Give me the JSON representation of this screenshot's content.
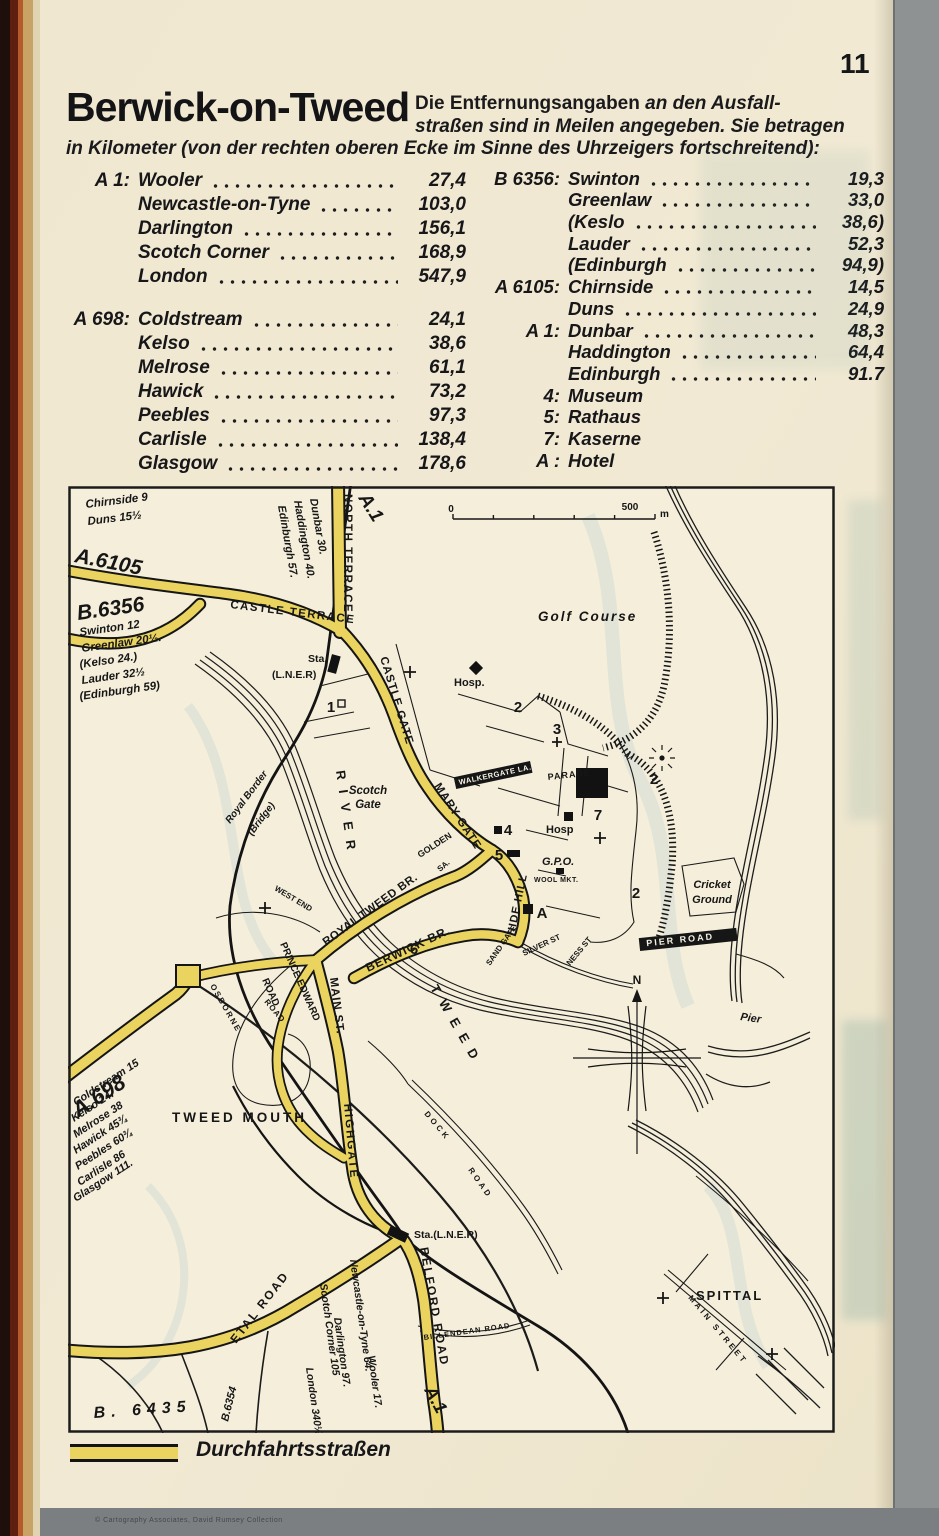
{
  "page": {
    "number": "11",
    "title": "Berwick-on-Tweed",
    "intro_bold": "Die Entfernungsangaben",
    "intro_1": "an den Ausfall-",
    "intro_2": "straßen sind in Meilen angegeben. Sie betragen",
    "intro_3": "in Kilometer (von der rechten oberen Ecke im Sinne des Uhrzeigers fortschreitend):"
  },
  "distances": {
    "left": [
      {
        "road": "A 1:",
        "entries": [
          [
            "Wooler",
            "27,4"
          ],
          [
            "Newcastle-on-Tyne",
            "103,0"
          ],
          [
            "Darlington",
            "156,1"
          ],
          [
            "Scotch Corner",
            "168,9"
          ],
          [
            "London",
            "547,9"
          ]
        ]
      },
      {
        "road": "A 698:",
        "entries": [
          [
            "Coldstream",
            "24,1"
          ],
          [
            "Kelso",
            "38,6"
          ],
          [
            "Melrose",
            "61,1"
          ],
          [
            "Hawick",
            "73,2"
          ],
          [
            "Peebles",
            "97,3"
          ],
          [
            "Carlisle",
            "138,4"
          ],
          [
            "Glasgow",
            "178,6"
          ]
        ]
      }
    ],
    "right": [
      {
        "road": "B 6356:",
        "entries": [
          [
            "Swinton",
            "19,3"
          ],
          [
            "Greenlaw",
            "33,0"
          ],
          [
            "(Keslo",
            "38,6)"
          ],
          [
            "Lauder",
            "52,3"
          ],
          [
            "(Edinburgh",
            "94,9)"
          ]
        ]
      },
      {
        "road": "A 6105:",
        "entries": [
          [
            "Chirnside",
            "14,5"
          ],
          [
            "Duns",
            "24,9"
          ]
        ]
      },
      {
        "road": "A 1:",
        "entries": [
          [
            "Dunbar",
            "48,3"
          ],
          [
            "Haddington",
            "64,4"
          ],
          [
            "Edinburgh",
            "91.7"
          ]
        ]
      }
    ],
    "key": [
      [
        "4:",
        "Museum"
      ],
      [
        "5:",
        "Rathaus"
      ],
      [
        "7:",
        "Kaserne"
      ],
      [
        "A :",
        "Hotel"
      ]
    ]
  },
  "map": {
    "scale": {
      "zero": "0",
      "five_hundred": "500",
      "unit": "m"
    },
    "notes": {
      "chirnside": [
        "Chirnside 9",
        "Duns 15½"
      ],
      "swinton": [
        "Swinton 12",
        "Greenlaw 20½.",
        "(Kelso 24.)",
        "Lauder 32½",
        "(Edinburgh 59)"
      ],
      "dunbar": [
        "Dunbar 30.",
        "Haddington 40.",
        "Edinburgh 57."
      ],
      "coldstream": [
        "Coldstream 15",
        "Kelso 24.",
        "Melrose 38",
        "Hawick 45¾",
        "Peebles 60¾",
        "Carlisle 86",
        "Glasgow 111."
      ],
      "wooler": [
        "Wooler 17.",
        "Newcastle-on-Tyne 64.",
        "Darlington 97.",
        "Scotch Corner 105",
        "London 340½"
      ]
    },
    "roads": {
      "a6105": "A.6105",
      "b6356": "B.6356",
      "a1_top": "A.1",
      "a1_bottom": "A.1",
      "a698": "A.698",
      "b6435": "B. 6435",
      "b6354": "B.6354",
      "north_terrace": "NORTH TERRACE",
      "castle_terrace": "CASTLE TERRACE",
      "castle_gate": "CASTLE GATE",
      "mary_gate": "MARY GATE",
      "golden": "GOLDEN",
      "hide_hill": "HIDE HILL",
      "walkergate": "WALKERGATE LA.",
      "parade": "PARADE",
      "royal_tweed_br": "ROYAL TWEED BR.",
      "berwick_br": "BERWICK BR.",
      "main_st": "MAIN ST.",
      "highgate": "HIGHGATE",
      "prince_edward": "PRINCE EDWARD",
      "prince_edward_road": "ROAD",
      "west_end": "WEST END",
      "osborne": "OSBORNE",
      "osborne_road": "ROAD",
      "etal_road": "ETAL ROAD",
      "belford_road": "BELFORD ROAD",
      "pier_road": "PIER ROAD",
      "dock_1": "DOCK",
      "dock_2": "ROAD",
      "billendean": "BILLENDEAN ROAD",
      "main_street": "MAIN STREET",
      "silver_st": "SILVER ST",
      "ness_st": "NESS ST",
      "sand_gate": "SAND GATE",
      "sa": "SA."
    },
    "places": {
      "golf_course": "Golf Course",
      "cricket_1": "Cricket",
      "cricket_2": "Ground",
      "tweedmouth": "TWEED MOUTH",
      "spittal": "SPITTAL",
      "pier": "Pier",
      "river": "RIVER",
      "tweed": "TWEED",
      "scotch_gate_1": "Scotch",
      "scotch_gate_2": "Gate",
      "royal_border_1": "Royal Border",
      "royal_border_2": "(Bridge)",
      "hosp_top": "Hosp.",
      "hosp_mid": "Hosp",
      "gpo": "G.P.O.",
      "wool_mkt": "WOOL MKT.",
      "sta_top_1": "Sta.",
      "sta_top_2": "(L.N.E.R)",
      "sta_bottom": "Sta.(L.N.E.R)",
      "compass_n": "N"
    },
    "markers": {
      "n1": "1",
      "n2": "2",
      "n3": "3",
      "n4": "4",
      "n5": "5",
      "n6": "6",
      "n7": "7",
      "hotel": "A"
    }
  },
  "legend": {
    "label": "Durchfahrtsstraßen"
  },
  "footer": {
    "text": "© Cartography Associates, David Rumsey Collection"
  }
}
